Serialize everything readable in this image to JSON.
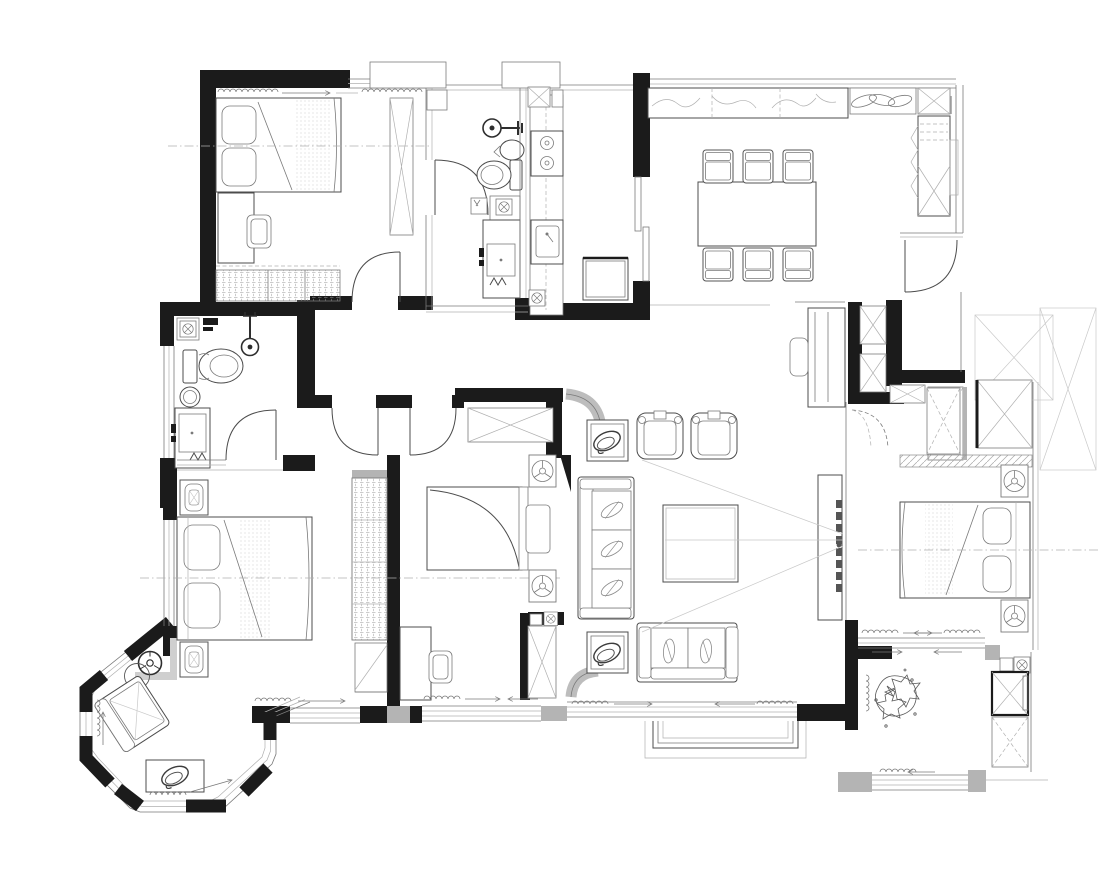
{
  "document": {
    "type": "architectural-floor-plan",
    "style": "black-and-white CAD drawing",
    "view": "top-down plan view"
  },
  "colors": {
    "background": "#ffffff",
    "wall": "#1b1b1b",
    "column_gray": "#b4b4b4",
    "light_wall_gray": "#cfcfcf",
    "furniture_line": "#4c4c4c",
    "detail_line": "#7a7a7a",
    "faint_line": "#b0b0b0"
  },
  "rooms": [
    {
      "name": "bedroom-top-left",
      "furniture": [
        "double-bed",
        "pillows-2",
        "desk",
        "desk-chair",
        "tall-closet",
        "shelved-wardrobe",
        "window-curtains"
      ]
    },
    {
      "name": "ensuite-bathroom",
      "furniture": [
        "shower-head",
        "washbasin",
        "toilet",
        "storage-box",
        "vanity-sink",
        "floor-drain"
      ]
    },
    {
      "name": "kitchen",
      "furniture": [
        "counter",
        "cooktop-2-burner",
        "kitchen-sink",
        "refrigerator",
        "upper-cabinet",
        "sliding-door"
      ]
    },
    {
      "name": "dining-room",
      "furniture": [
        "marble-sideboard",
        "dining-table",
        "dining-chairs-6",
        "planter-box",
        "tall-display-cabinet"
      ]
    },
    {
      "name": "entry-hall",
      "furniture": [
        "entry-door",
        "shoe-cabinet",
        "storage-closets-4"
      ]
    },
    {
      "name": "bathroom-left",
      "furniture": [
        "toilet",
        "round-basin",
        "vanity-sink",
        "shower-head",
        "storage-box",
        "floor-drain"
      ]
    },
    {
      "name": "master-bedroom",
      "furniture": [
        "double-bed",
        "pillows-2",
        "nightstands-2",
        "table-lamps-2",
        "hatched-wardrobe",
        "mirror-cabinet",
        "window-curtains"
      ]
    },
    {
      "name": "bay-window-lounge",
      "furniture": [
        "lounge-chair",
        "floor-lamp",
        "side-table",
        "octagonal-bay-windows",
        "curtains"
      ]
    },
    {
      "name": "middle-bedroom",
      "furniture": [
        "bed",
        "headboard-cushion",
        "nightstands-2",
        "round-lamps-2",
        "overhead-wardrobe",
        "desk",
        "desk-chair",
        "storage-closet"
      ]
    },
    {
      "name": "living-room",
      "furniture": [
        "sofa-3-seat",
        "loveseat-2-seat",
        "armchairs-2",
        "coffee-table",
        "side-tables-2",
        "decor-bowls-2",
        "tv-panel",
        "tv-console"
      ]
    },
    {
      "name": "bedroom-right",
      "furniture": [
        "double-bed",
        "pillows-2",
        "nightstands-2",
        "round-lamps-2",
        "closet",
        "wardrobe",
        "window-curtains"
      ]
    },
    {
      "name": "balcony",
      "furniture": [
        "plant",
        "washing-machine",
        "storage-cabinet",
        "utility-boxes"
      ]
    }
  ],
  "annotations": {
    "door_arcs": 7,
    "dashed_fold_door": "bedroom-right entry",
    "sight_lines": "sofa and chairs to tv panel",
    "center_dash_lines": "through beds",
    "curtain_scallops_with_arrows": "along exterior windows"
  }
}
